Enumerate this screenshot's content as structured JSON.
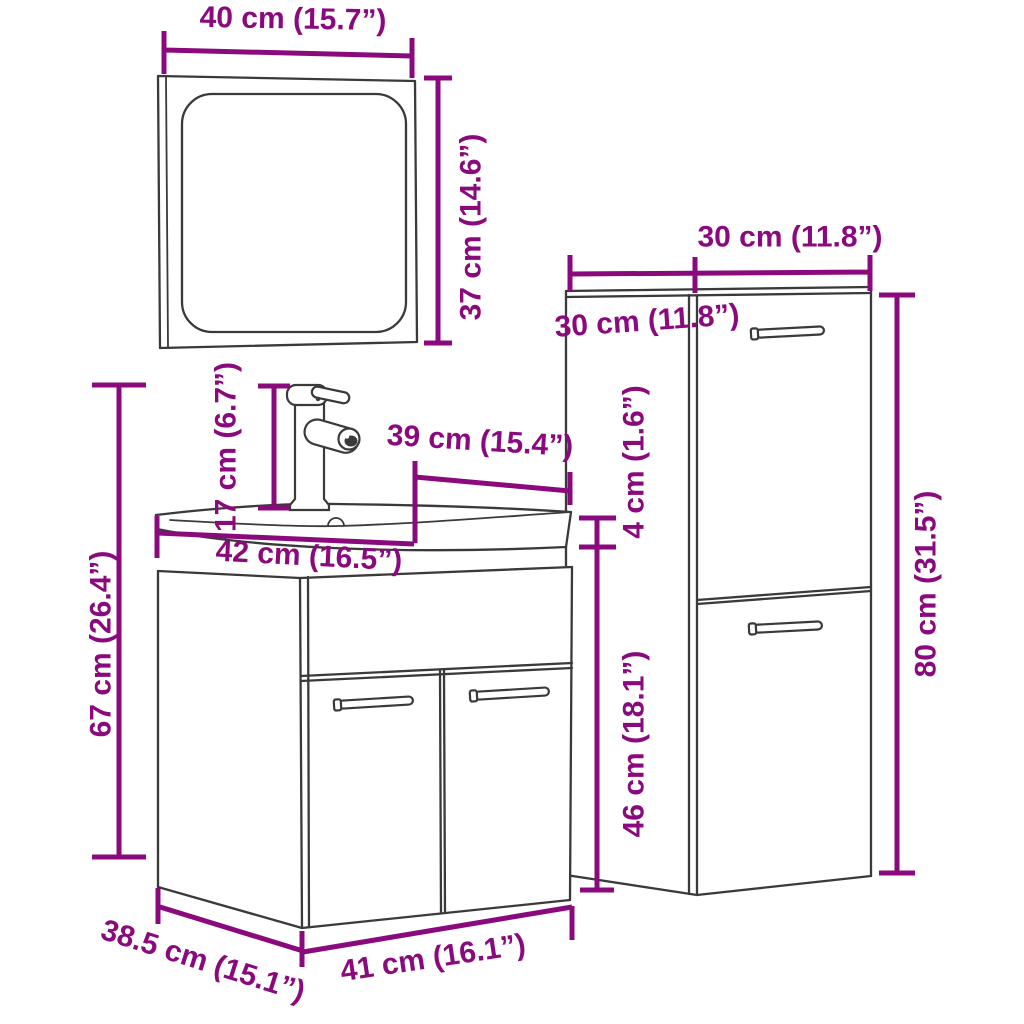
{
  "diagram": {
    "colors": {
      "accent": "#8A0A7E",
      "line": "#3A3A3A",
      "background": "#FFFFFF"
    },
    "dimensions": {
      "mirror_width": "40 cm (15.7”)",
      "mirror_height": "37 cm (14.6”)",
      "faucet_height": "17 cm (6.7”)",
      "basin_width": "39 cm (15.4”)",
      "sink_top_width": "42 cm (16.5”)",
      "vanity_total_height": "67 cm (26.4”)",
      "vanity_depth": "38.5 cm (15.1”)",
      "vanity_width": "41 cm (16.1”)",
      "wall_cabinet_width": "30 cm (11.8”)",
      "wall_cabinet_depth": "30 cm (11.8”)",
      "basin_height": "4 cm (1.6”)",
      "vanity_cabinet_height": "46 cm (18.1”)",
      "wall_cabinet_height": "80 cm (31.5”)"
    }
  }
}
